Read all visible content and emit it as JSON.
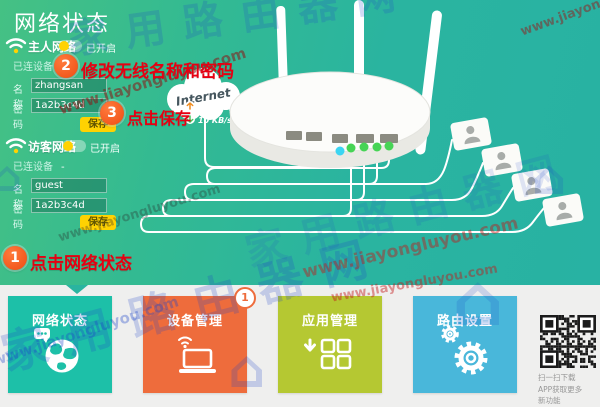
{
  "header": {
    "title": "网络状态"
  },
  "watermarks": {
    "url": "www.jiayongluyou.com",
    "site": "家用路由器网",
    "house_glyph": "⌂"
  },
  "sidebar": {
    "sections": [
      {
        "title": "主人网络",
        "status": "已开启",
        "devices_label": "已连设备",
        "devices_value": "-",
        "name_label": "名称",
        "name_value": "zhangsan",
        "password_label": "密码",
        "password_value": "1a2b3c4d",
        "save_label": "保存"
      },
      {
        "title": "访客网络",
        "status": "已开启",
        "devices_label": "已连设备",
        "devices_value": "-",
        "name_label": "名称",
        "name_value": "guest",
        "password_label": "密码",
        "password_value": "1a2b3c4d",
        "save_label": "保存"
      }
    ]
  },
  "annotations": {
    "step1": {
      "num": "1",
      "text": "点击网络状态"
    },
    "step2": {
      "num": "2",
      "text": "修改无线名称和密码"
    },
    "step3": {
      "num": "3",
      "text": "点击保存"
    }
  },
  "diagram": {
    "cloud_label": "Internet",
    "speed_up": "100 KB/s",
    "speed_down": "10 KB/s"
  },
  "tiles": [
    {
      "label": "网络状态",
      "color": "#1dc0a8",
      "icon": "globe-icon"
    },
    {
      "label": "设备管理",
      "color": "#ee6c3c",
      "icon": "laptop-icon",
      "badge": "1"
    },
    {
      "label": "应用管理",
      "color": "#b5c832",
      "icon": "apps-icon"
    },
    {
      "label": "路由设置",
      "color": "#49b7da",
      "icon": "gear-icon"
    }
  ],
  "qr": {
    "caption_lines": [
      "扫一扫下载",
      "APP获取更多",
      "新功能"
    ]
  },
  "colors": {
    "accent_red": "#e60012",
    "badge_orange": "#ee4c12",
    "save_yellow": "#ffd202",
    "teal_background": "#2ab4a0"
  }
}
